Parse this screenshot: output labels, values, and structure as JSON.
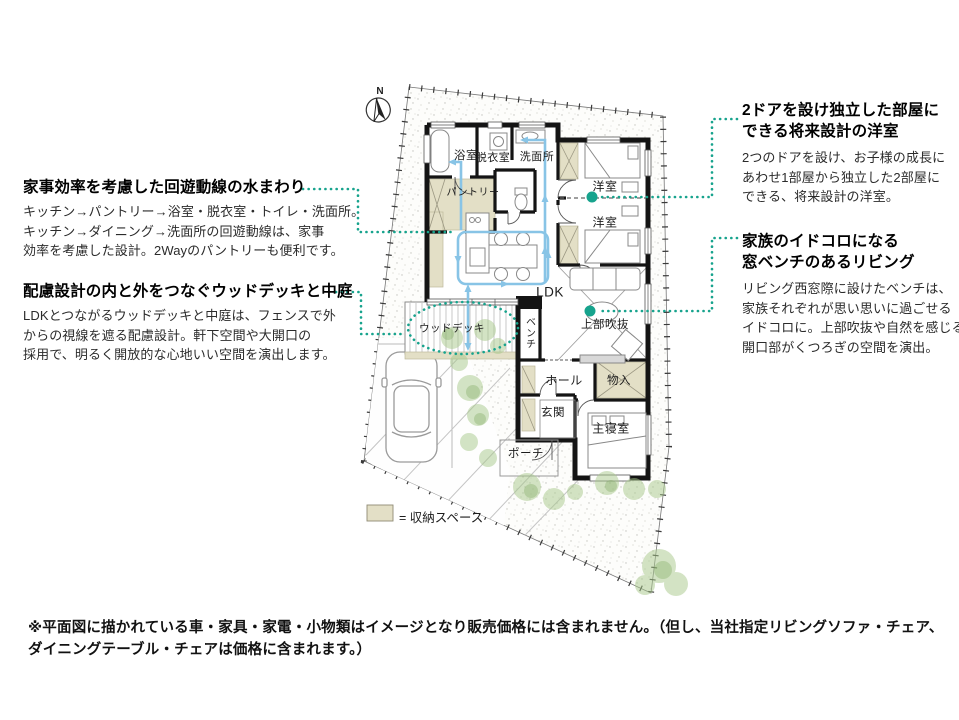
{
  "colors": {
    "accent_teal": "#17a38d",
    "arrow_blue": "#88c4e6",
    "storage_beige": "#e3dfc6",
    "wall_black": "#141414",
    "tree_green": "#a8c98b"
  },
  "north_label": "N",
  "legend": {
    "label": "= 収納スペース"
  },
  "annotations": {
    "left_top": {
      "heading": "家事効率を考慮した回遊動線の水まわり",
      "body_lines": [
        "キッチン→パントリー→浴室・脱衣室・トイレ・洗面所。",
        "キッチン→ダイニング→洗面所の回遊動線は、家事",
        "効率を考慮した設計。2Wayのパントリーも便利です。"
      ]
    },
    "left_bottom": {
      "heading": "配慮設計の内と外をつなぐウッドデッキと中庭",
      "body_lines": [
        "LDKとつながるウッドデッキと中庭は、フェンスで外",
        "からの視線を遮る配慮設計。軒下空間や大開口の",
        "採用で、明るく開放的な心地いい空間を演出します。"
      ]
    },
    "right_top": {
      "heading_lines": [
        "2ドアを設け独立した部屋に",
        "できる将来設計の洋室"
      ],
      "body_lines": [
        "2つのドアを設け、お子様の成長に",
        "あわせ1部屋から独立した2部屋に",
        "できる、将来設計の洋室。"
      ]
    },
    "right_bottom": {
      "heading_lines": [
        "家族のイドコロになる",
        "窓ベンチのあるリビング"
      ],
      "body_lines": [
        "リビング西窓際に設けたベンチは、",
        "家族それぞれが思い思いに過ごせる",
        "イドコロに。上部吹抜や自然を感じる",
        "開口部がくつろぎの空間を演出。"
      ]
    }
  },
  "rooms": {
    "bath": "浴室",
    "dressing": "脱衣室",
    "washroom": "洗面所",
    "pantry": "パントリー",
    "west_room_1": "洋室",
    "west_room_2": "洋室",
    "ldk": "LDK",
    "wood_deck": "ウッドデッキ",
    "bench": "ベンチ",
    "void_above": "上部吹抜",
    "hall": "ホール",
    "closet": "物入",
    "entrance": "玄関",
    "master_bedroom": "主寝室",
    "porch": "ポーチ"
  },
  "disclaimer_lines": [
    "※平面図に描かれている車・家具・家電・小物類はイメージとなり販売価格には含まれません。（但し、当社指定リビングソファ・チェア、",
    "ダイニングテーブル・チェアは価格に含まれます。）"
  ]
}
